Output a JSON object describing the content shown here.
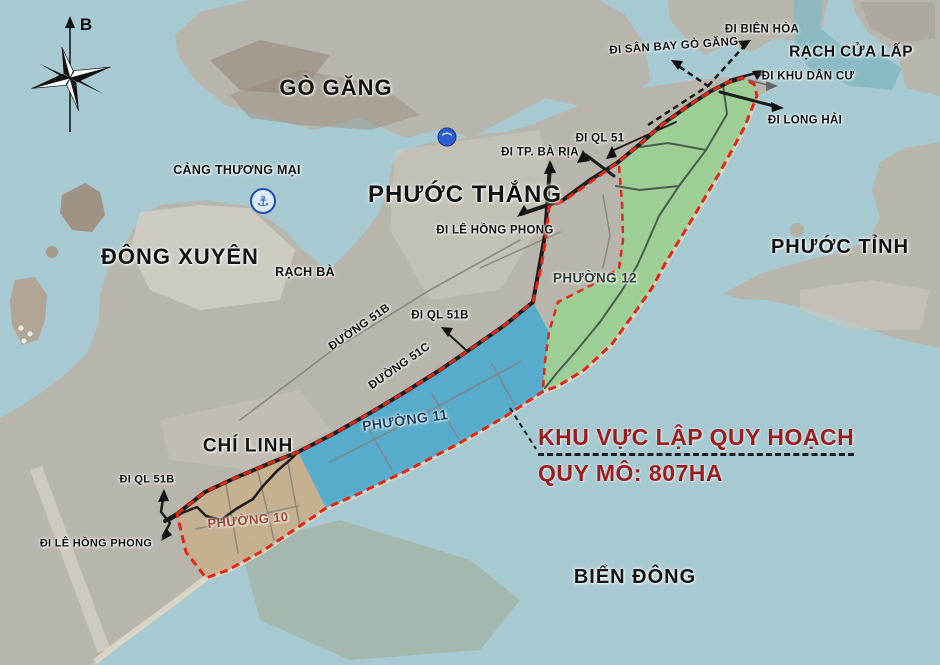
{
  "map": {
    "compass": {
      "north_label": "B"
    },
    "region_labels": {
      "go_gang": "GÒ GĂNG",
      "dong_xuyen": "ĐÔNG XUYÊN",
      "phuoc_thang": "PHƯỚC THẮNG",
      "phuoc_tinh": "PHƯỚC TỈNH",
      "chi_linh": "CHÍ LINH",
      "bien_dong": "BIỂN ĐÔNG",
      "rach_cua_lap": "RẠCH CỬA LẤP",
      "rach_ba": "RẠCH BÀ",
      "cang_thuong_mai": "CẢNG THƯƠNG MẠI"
    },
    "ward_labels": {
      "phuong_10": "PHƯỜNG 10",
      "phuong_11": "PHƯỜNG 11",
      "phuong_12": "PHƯỜNG 12"
    },
    "road_labels": {
      "duong_51b": "ĐƯỜNG 51B",
      "duong_51c": "ĐƯỜNG 51C"
    },
    "direction_labels": {
      "di_tp_ba_ria": "ĐI TP. BÀ RỊA",
      "di_le_hong_phong": "ĐI LÊ HỒNG PHONG",
      "di_ql_51": "ĐI QL 51",
      "di_ql_51b_mid": "ĐI QL 51B",
      "di_san_bay_go_gang": "ĐI SÂN BAY GÒ GĂNG",
      "di_bien_hoa": "ĐI BIÊN HÒA",
      "di_khu_dan_cu": "ĐI KHU DÂN CƯ",
      "di_long_hai": "ĐI LONG HẢI",
      "di_ql_51b_left": "ĐI QL 51B",
      "di_le_hong_phong_left": "ĐI LÊ HỒNG PHONG"
    },
    "annotation": {
      "line1": "KHU VỰC LẬP QUY HOẠCH",
      "line2": "QUY MÔ: 807HA"
    },
    "icons": {
      "anchor": "⚓",
      "bridge": "⌒"
    },
    "colors": {
      "sea": "#a7c9d1",
      "river": "#85b8c3",
      "land": "#b8b5ac",
      "land_dark": "#a49e91",
      "zone_green": "#99d293",
      "zone_blue": "#4aabcf",
      "zone_tan": "#c7af8c",
      "boundary_red": "#e02818",
      "road_black": "#1c1c1c",
      "road_grey": "#8a8a80",
      "zone_road_green": "#4a5d4e",
      "annotation_red": "#9b1c1c",
      "ward10_text": "#9c4632",
      "ward11_text": "#1d3d5c",
      "ward12_text": "#2f4038"
    }
  }
}
